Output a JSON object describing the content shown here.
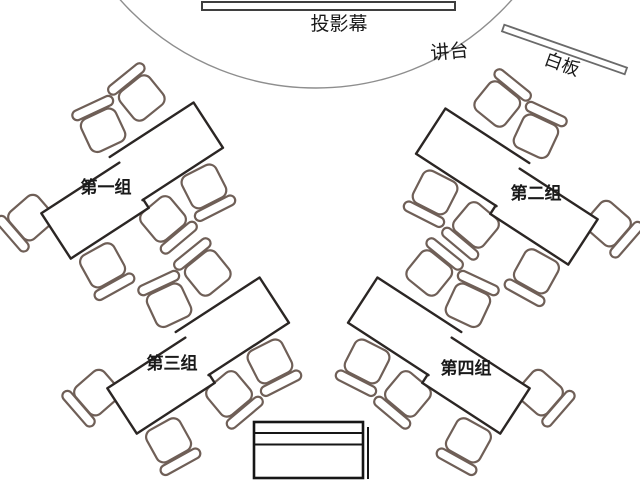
{
  "diagram": {
    "screen_label": "投影幕",
    "podium_label": "讲台",
    "whiteboard_label": "白板",
    "groups": [
      {
        "label": "第一组",
        "chairs": 6,
        "desks": 2,
        "tilt": "left"
      },
      {
        "label": "第二组",
        "chairs": 6,
        "desks": 2,
        "tilt": "right"
      },
      {
        "label": "第三组",
        "chairs": 6,
        "desks": 2,
        "tilt": "left"
      },
      {
        "label": "第四组",
        "chairs": 6,
        "desks": 2,
        "tilt": "right"
      }
    ],
    "colors": {
      "background": "#ffffff",
      "table_stroke": "#2b2624",
      "chair_stroke": "#6f5f57",
      "arc_stroke": "#8e8e8e",
      "screen_stroke": "#3f3f3f",
      "board_stroke": "#6a6a6a",
      "desk_stroke": "#161616",
      "text": "#1a1a1a"
    }
  }
}
